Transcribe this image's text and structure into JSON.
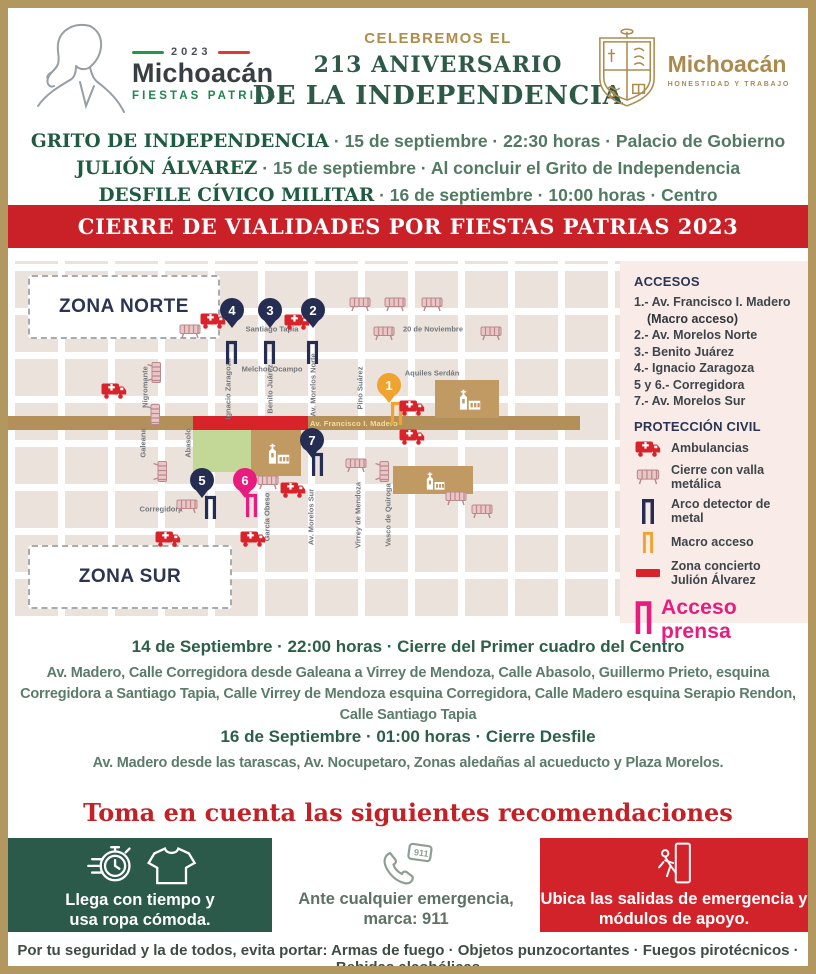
{
  "header": {
    "logo_left": {
      "year": "2023",
      "brand": "Michoacán",
      "sub": "FIESTAS PATRIAS"
    },
    "title": {
      "line1": "CELEBREMOS EL",
      "line2": "213 ANIVERSARIO",
      "line3": "DE LA INDEPENDENCIA"
    },
    "logo_right": {
      "brand": "Michoacán",
      "sub": "HONESTIDAD Y TRABAJO"
    }
  },
  "events": [
    {
      "name": "GRITO DE INDEPENDENCIA",
      "details": "· 15 de septiembre · 22:30 horas · Palacio de Gobierno"
    },
    {
      "name": "JULIÓN ÁLVAREZ",
      "details": "· 15 de septiembre · Al concluir el Grito de Independencia"
    },
    {
      "name": "DESFILE CÍVICO MILITAR",
      "details": "· 16 de septiembre · 10:00 horas · Centro"
    }
  ],
  "banner": {
    "text": "CIERRE DE VIALIDADES POR FIESTAS PATRIAS 2023"
  },
  "map": {
    "zone_north": "ZONA NORTE",
    "zone_south": "ZONA SUR",
    "road_label": "Av. Francisco I. Madero",
    "streets": [
      "Santiago Tapia",
      "Melchor Ocampo",
      "20 de Noviembre",
      "Aquiles Serdán",
      "Corregidora",
      "Nigromante",
      "Galeana",
      "Abasolo",
      "Ignacio Zaragoza",
      "Benito Juárez",
      "Av. Morelos Norte",
      "Pino Suárez",
      "García Obeso",
      "Av. Morelos Sur",
      "Virrey de Mendoza",
      "Vasco de Quiroga"
    ],
    "pins": [
      "1",
      "2",
      "3",
      "4",
      "5",
      "6",
      "7"
    ],
    "legend": {
      "accesos_title": "ACCESOS",
      "accesos": [
        "1.- Av. Francisco I. Madero",
        "(Macro acceso)",
        "2.- Av. Morelos Norte",
        "3.- Benito Juárez",
        "4.- Ignacio Zaragoza",
        "5 y 6.- Corregidora",
        "7.- Av. Morelos Sur"
      ],
      "proteccion_title": "PROTECCIÓN CIVIL",
      "items": [
        "Ambulancias",
        "Cierre con valla metálica",
        "Arco detector de metal",
        "Macro acceso",
        "Zona concierto Julión Álvarez"
      ],
      "prensa": "Acceso prensa"
    },
    "colors": {
      "navy": "#252e52",
      "gold": "#f0a32f",
      "pink": "#e81c7f",
      "red": "#d8232a",
      "road": "#b3905a"
    }
  },
  "closures": [
    {
      "title": "14 de Septiembre · 22:00 horas · Cierre del Primer cuadro del Centro",
      "body": "Av. Madero, Calle Corregidora desde Galeana a Virrey de Mendoza, Calle Abasolo, Guillermo Prieto, esquina Corregidora a Santiago Tapia, Calle Virrey de Mendoza esquina Corregidora, Calle Madero esquina Serapio Rendon, Calle Santiago Tapia"
    },
    {
      "title": "16 de Septiembre · 01:00 horas ·  Cierre Desfile",
      "body": "Av. Madero desde las tarascas, Av. Nocupetaro, Zonas aledañas al acueducto y Plaza Morelos."
    }
  ],
  "recommendations": {
    "title": "Toma en cuenta las siguientes recomendaciones",
    "call_badge": "911",
    "boxes": [
      {
        "line1": "Llega con tiempo y",
        "line2": "usa ropa cómoda."
      },
      {
        "line1": "Ante cualquier emergencia,",
        "line2": "marca: 911"
      },
      {
        "line1": "Ubica las salidas de emergencia y",
        "line2": "módulos de apoyo."
      }
    ],
    "footer": "Por tu seguridad y la de todos, evita portar: Armas de fuego · Objetos punzocortantes · Fuegos pirotécnicos · Bebidas alcohólicas"
  }
}
